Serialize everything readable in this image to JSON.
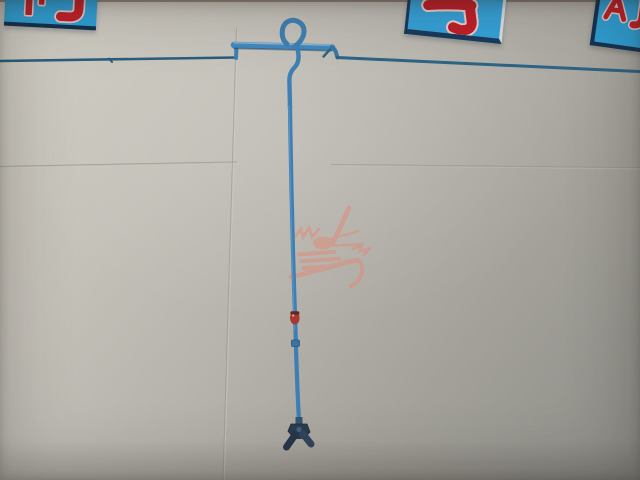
{
  "scene": {
    "description": "Photograph of a pale panelled wall carrying a blue pipe line: a thin run from the left rises to a thicker horizontal section topped by a circular loop, then a long vertical drop with a small red valve and a collar joint, ending in a dark Y-shaped nozzle; a second thin run slopes away to the right edge. Three blue signs with cropped red Chinese character fragments hang along the top edge, and a faint pink dragon-logo watermark sits mid-frame."
  },
  "wall": {
    "color_top_left": "#d0cdc4",
    "color_bottom_right": "#8d8c86",
    "seams": [
      "vertical-center-seam",
      "horizontal-seam-left",
      "horizontal-seam-right"
    ]
  },
  "signs": [
    {
      "id": "sign-left",
      "background": "#2f9fd4",
      "border": "#14304b",
      "glyph_color": "#bf2028",
      "glyphs": "two cropped red character fragments"
    },
    {
      "id": "sign-middle",
      "background": "#35a2d8",
      "border": "#1a3a5c",
      "glyph_color": "#bf2028",
      "glyphs": "one cropped red hook-stroke character fragment"
    },
    {
      "id": "sign-right",
      "background": "#2f9fd4",
      "border": "#16324e",
      "glyph_color": "#bf2028",
      "glyphs": "two cropped red character fragments"
    }
  ],
  "pipe": {
    "main_color": "#4389bd",
    "thin_left_color": "#2b5d7b",
    "thin_right_color": "#2e6485",
    "valve_color": "#a63a33",
    "collar_color": "#3a74a4",
    "nozzle_color": "#2b3c4e",
    "features": [
      "thin-left-run",
      "step-elbow",
      "thick-top-run",
      "loop",
      "right-elbow",
      "thin-right-run",
      "vertical-drop",
      "red-valve",
      "collar-joint",
      "y-nozzle"
    ]
  },
  "watermark": {
    "color": "#e08a78",
    "shape": "dragon-logo"
  }
}
